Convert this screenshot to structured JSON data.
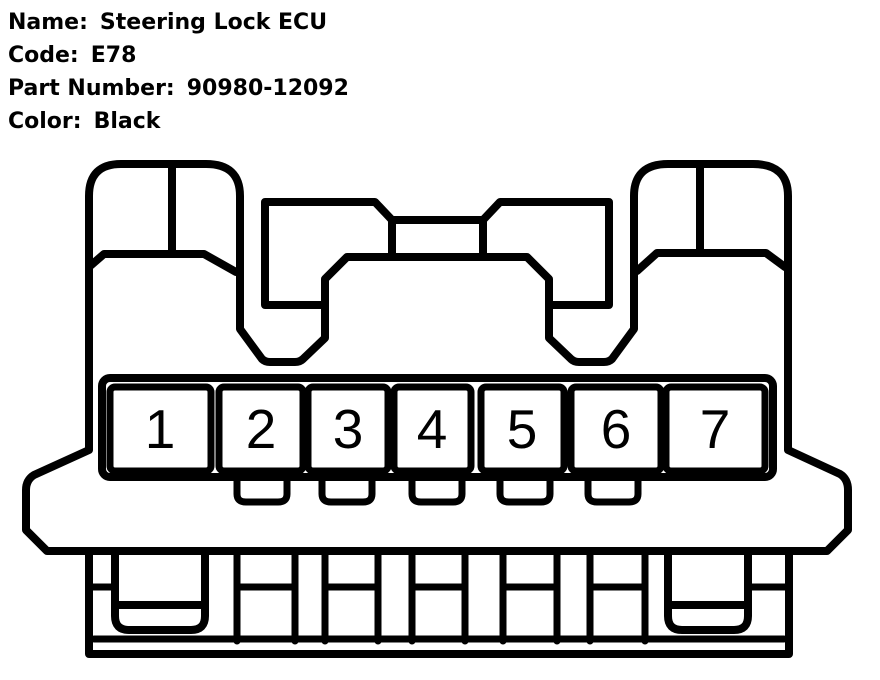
{
  "header": {
    "fields": [
      {
        "label": "Name:",
        "value": "Steering Lock ECU"
      },
      {
        "label": "Code:",
        "value": "E78"
      },
      {
        "label": "Part Number:",
        "value": "90980-12092"
      },
      {
        "label": "Color:",
        "value": "Black"
      }
    ]
  },
  "connector": {
    "pin_count": 7,
    "pins": [
      "1",
      "2",
      "3",
      "4",
      "5",
      "6",
      "7"
    ],
    "line_color": "#000000",
    "background_color": "#ffffff"
  }
}
